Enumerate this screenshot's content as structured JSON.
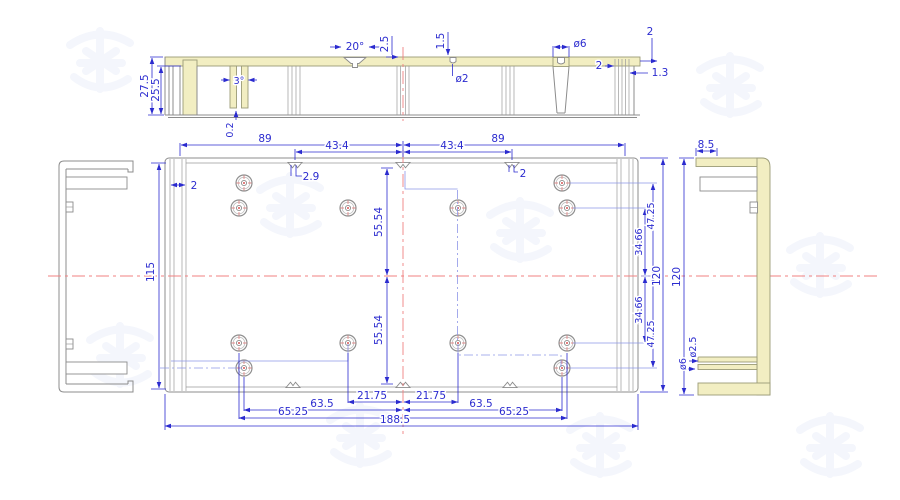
{
  "drawing": {
    "title": "aluminum enclosure profile drawing",
    "watermark_text": "鸿发",
    "colors": {
      "outline": "#8c8c8c",
      "profile_fill": "#f2eec2",
      "dimension": "#2b2bcf",
      "centerline": "#f08080",
      "construction": "#8d96e8",
      "watermark": "#f0f3fb"
    },
    "section": {
      "outer_height": "27.5",
      "inner_height": "25.5",
      "rib_slot": "3°",
      "rib_tip_gap": "0.2",
      "notch_angle": "20°",
      "notch_depth": "2.5",
      "pilot_depth": "1.5",
      "pilot_dia": "ø2",
      "boss_dia": "ø6",
      "edge_step": "2",
      "groove_width": "2",
      "groove_offset": "1.3"
    },
    "plan": {
      "half_left": "89",
      "half_right": "89",
      "inner_left": "43.4",
      "inner_right": "43.4",
      "notch_left": "2.9",
      "notch_right": "2",
      "wall": "2",
      "inner_height": "115",
      "outer_height": "120",
      "row_top_outer": "47.25",
      "row_top_inner": "34.66",
      "row_bottom_inner": "34.66",
      "row_bottom_outer": "47.25",
      "pitch_up": "55.54",
      "pitch_down": "55.54",
      "col_inner_left": "21.75",
      "col_inner_right": "21.75",
      "col_mid_left": "63.5",
      "col_mid_right": "63.5",
      "col_outer_left": "65.25",
      "col_outer_right": "65.25",
      "total_width": "188.5"
    },
    "right_view": {
      "flange": "8.5",
      "height": "120",
      "boss_outer": "ø6",
      "boss_inner": "ø2.5"
    }
  }
}
